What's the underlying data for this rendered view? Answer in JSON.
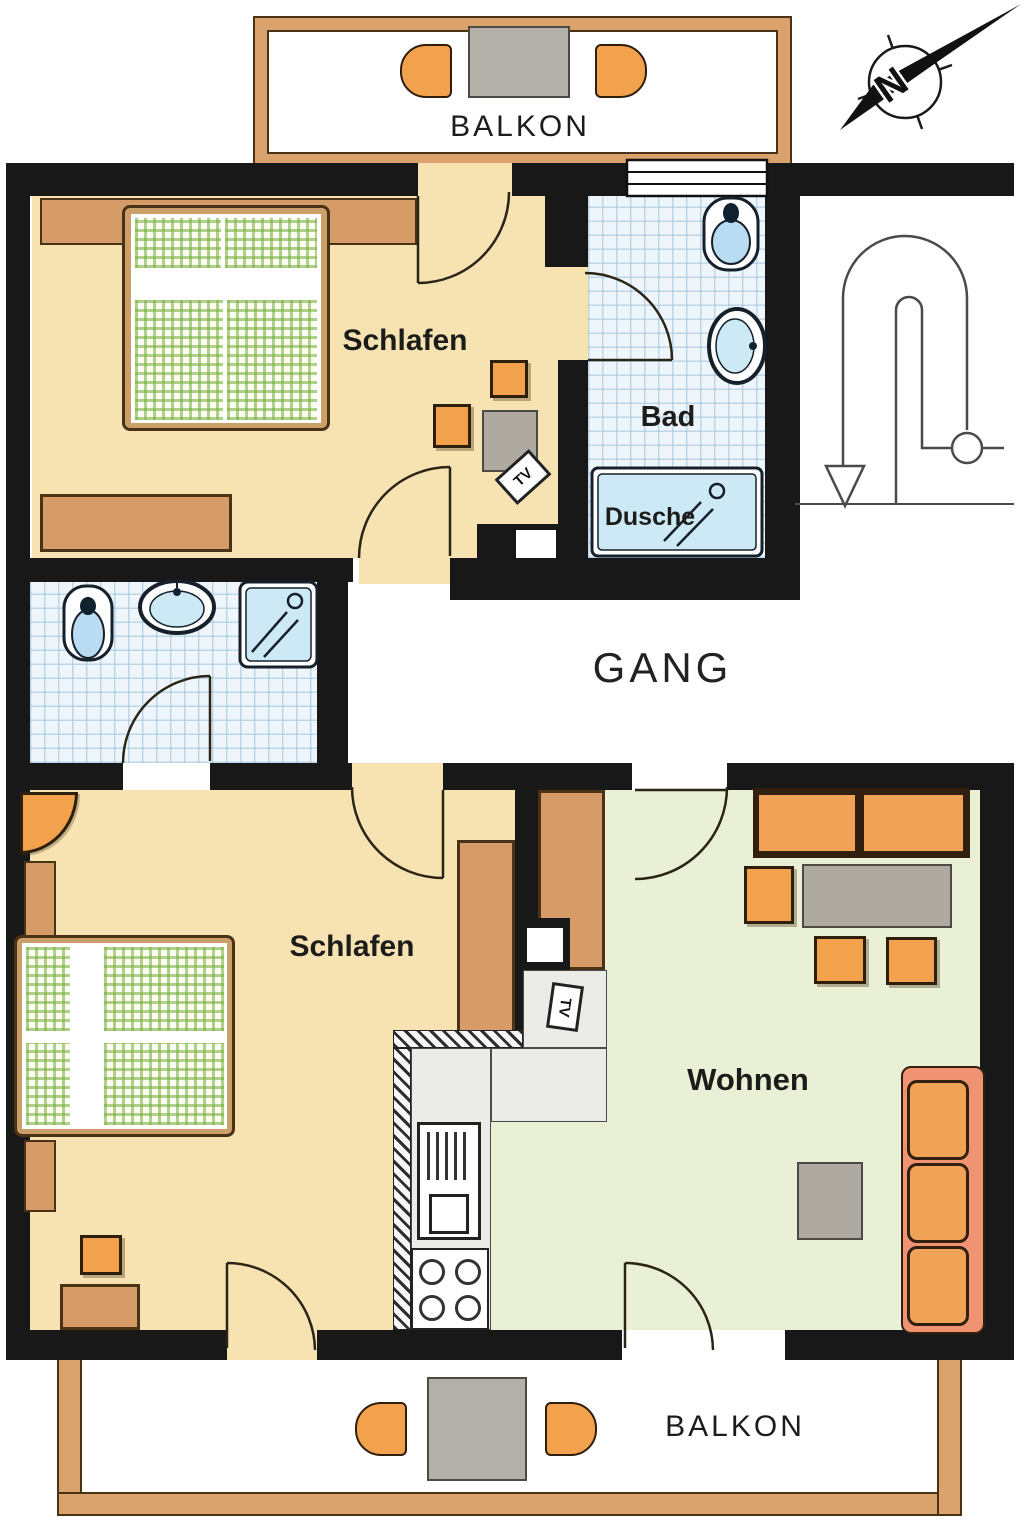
{
  "image_type": "apartment floor plan",
  "labels": {
    "balkon": "BALKON",
    "schlafen": "Schlafen",
    "bad": "Bad",
    "dusche": "Dusche",
    "gang": "GANG",
    "wohnen": "Wohnen",
    "tv": "TV",
    "north": "N"
  },
  "rooms": [
    {
      "name": "Balkon (top)",
      "features": [
        "table",
        "2 chairs"
      ]
    },
    {
      "name": "Schlafen (top unit)",
      "features": [
        "double bed",
        "wardrobe",
        "sideboard",
        "2 stools",
        "table",
        "TV"
      ]
    },
    {
      "name": "Bad",
      "features": [
        "toilet",
        "sink",
        "shower tray Dusche",
        "window"
      ]
    },
    {
      "name": "Bathroom (lower unit)",
      "features": [
        "toilet",
        "sink",
        "shower"
      ]
    },
    {
      "name": "Gang",
      "features": [
        "corridor",
        "staircase with direction arrow"
      ]
    },
    {
      "name": "Schlafen (lower unit)",
      "features": [
        "double bed",
        "wardrobes",
        "corner lamp",
        "stool",
        "table",
        "TV"
      ]
    },
    {
      "name": "Kitchen",
      "features": [
        "L-counter",
        "oven",
        "4-burner stove"
      ]
    },
    {
      "name": "Wohnen",
      "features": [
        "2-seat sofa",
        "3-seat sofa",
        "coffee table",
        "3 chairs",
        "side table"
      ]
    },
    {
      "name": "Balkon (bottom)",
      "features": [
        "table",
        "2 chairs"
      ]
    }
  ],
  "colors": {
    "wall": "#181818",
    "bedroom_floor": "#f7e3b2",
    "living_floor": "#eaf0d6",
    "tile_floor": "#eef6fc",
    "fixture_blue": "#b9dcf2",
    "furniture_orange": "#f2a24c",
    "furniture_tan": "#d69c68",
    "sofa_salmon": "#ef9373",
    "table_gray": "#aeaaa2",
    "balcony_wall": "#daa26d"
  }
}
